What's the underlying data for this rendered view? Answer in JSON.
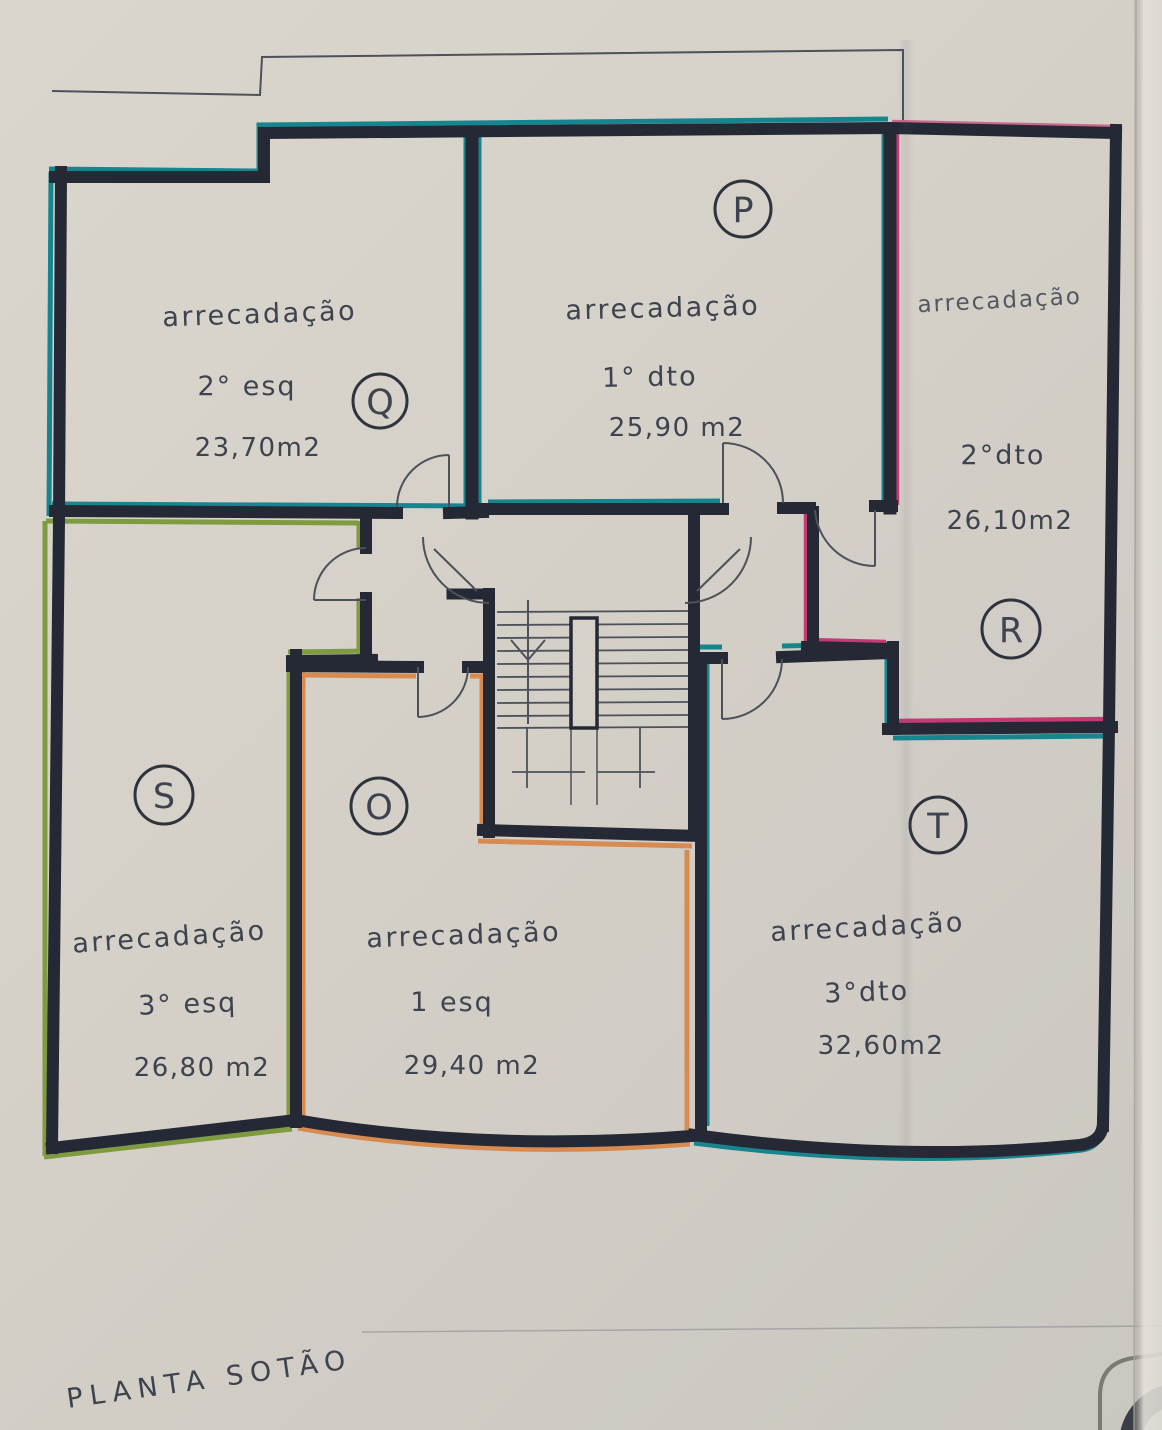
{
  "title": "PLANTA SOTÃO",
  "rooms": [
    {
      "letter": "P",
      "name": "arrecadação",
      "unit": "1° dto",
      "area": "25,90 m2"
    },
    {
      "letter": "Q",
      "name": "arrecadação",
      "unit": "2° esq",
      "area": "23,70m2"
    },
    {
      "letter": "R",
      "name": "arrecadação",
      "unit": "2°dto",
      "area": "26,10m2"
    },
    {
      "letter": "S",
      "name": "arrecadação",
      "unit": "3° esq",
      "area": "26,80 m2"
    },
    {
      "letter": "O",
      "name": "arrecadação",
      "unit": "1 esq",
      "area": "29,40 m2"
    },
    {
      "letter": "T",
      "name": "arrecadação",
      "unit": "3°dto",
      "area": "32,60m2"
    }
  ],
  "colors": {
    "paper": "#d6d2c9",
    "walls": "#242935",
    "ink": "#3e4350",
    "thin_line": "#4d515c",
    "teal": "#17858e",
    "green": "#7e9b40",
    "orange": "#d78b51",
    "pink": "#c53a72"
  }
}
